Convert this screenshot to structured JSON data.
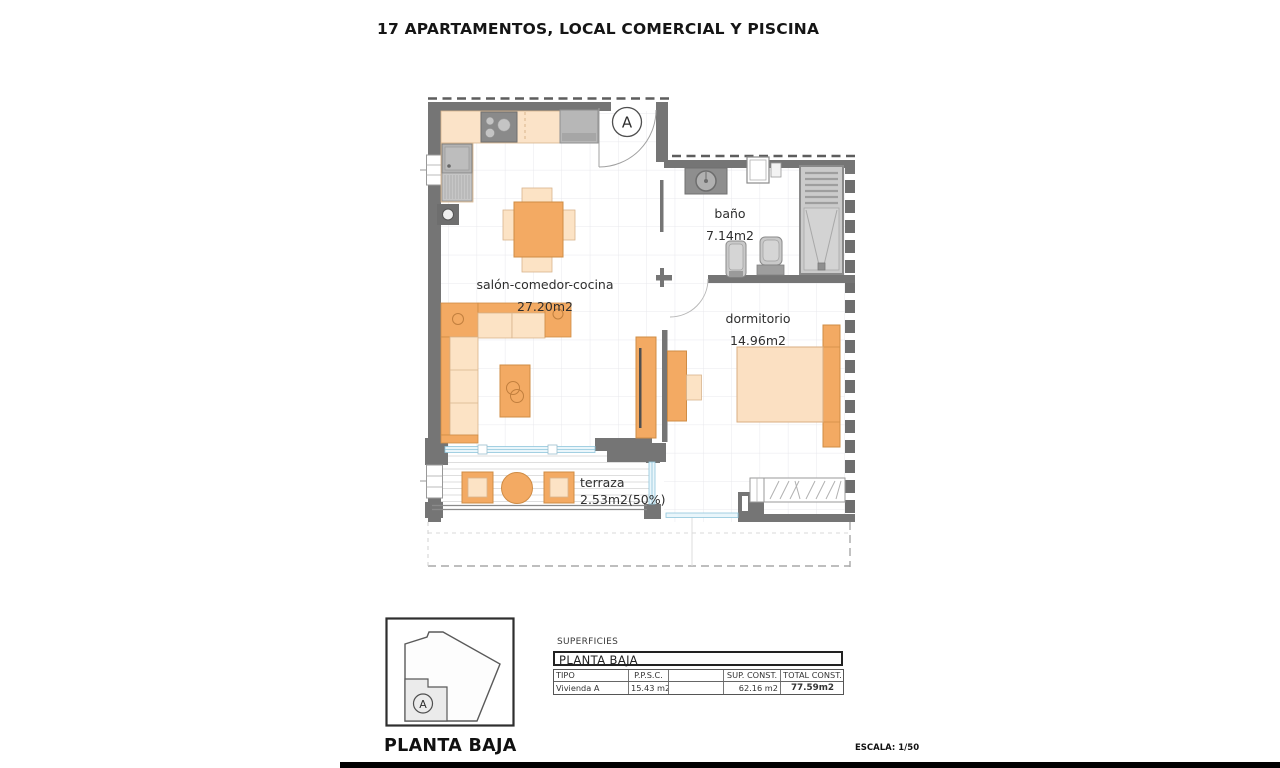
{
  "title": "17 APARTAMENTOS, LOCAL COMERCIAL Y PISCINA",
  "floor_plan": {
    "entry_marker": "A",
    "rooms": [
      {
        "name": "salón-comedor-cocina",
        "area": "27.20m2"
      },
      {
        "name": "baño",
        "area": "7.14m2"
      },
      {
        "name": "dormitorio",
        "area": "14.96m2"
      },
      {
        "name": "terraza",
        "area": "2.53m2(50%)"
      }
    ]
  },
  "key_plan": {
    "marker": "A",
    "caption": "PLANTA BAJA"
  },
  "superficies": {
    "label": "SUPERFICIES",
    "plan_header": "PLANTA BAJA",
    "columns": {
      "tipo": "TIPO",
      "ppsc": "P.P.S.C.",
      "blank": "",
      "sup_const": "SUP. CONST.",
      "total_const": "TOTAL CONST."
    },
    "row": {
      "tipo": "Vivienda A",
      "ppsc": "15.43 m2",
      "blank": "",
      "sup_const": "62.16 m2",
      "total_const": "77.59m2"
    }
  },
  "scale_label": "ESCALA: 1/50",
  "colors": {
    "wall": "#757575",
    "furniture_orange": "#f3aa63",
    "furniture_light": "#fce3c5",
    "counter_beige": "#fbe3c8",
    "fixture_gray": "#c9c9c9",
    "appliance_dark": "#8a8a8a",
    "glass_blue": "#eaf6fb",
    "bed_light": "#fbe0c2"
  }
}
